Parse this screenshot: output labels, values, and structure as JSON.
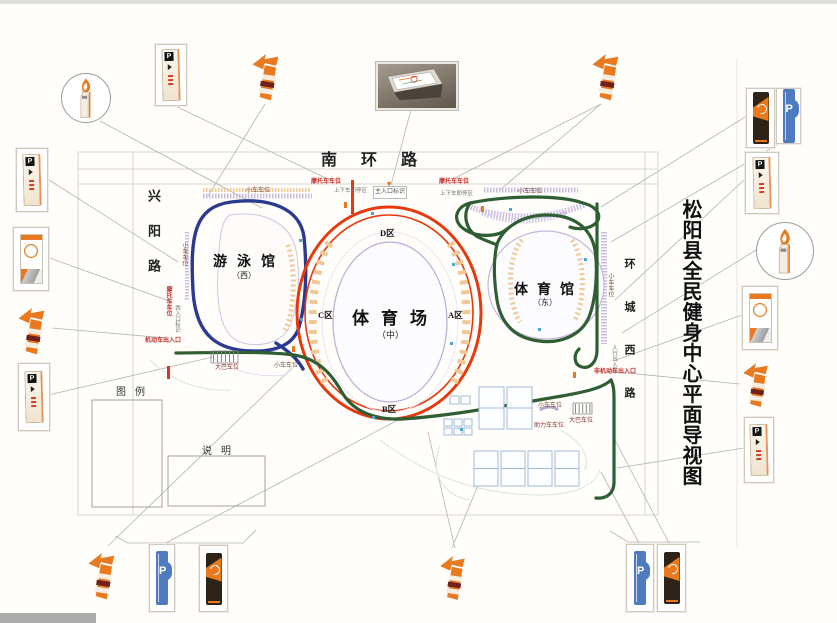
{
  "title": "松阳县全民健身中心平面导视图",
  "roads": {
    "north": "南环路",
    "west": "兴阳路",
    "east": "环城西路"
  },
  "buildings": {
    "pool": {
      "name": "游泳馆",
      "sub": "（西）"
    },
    "stadium": {
      "name": "体育场",
      "sub": "（中）"
    },
    "gym": {
      "name": "体育馆",
      "sub": "（东）"
    }
  },
  "zones": {
    "a": "A区",
    "b": "B区",
    "c": "C区",
    "d": "D区"
  },
  "legend": {
    "title": "图例",
    "note_title": "说明"
  },
  "labels": {
    "car_parking": "小车车位",
    "moto_parking": "摩托车车位",
    "bus_parking": "大巴车位",
    "moped_parking": "助力车车位",
    "dropoff": "上下车即停区",
    "main_entrance_sign": "主入口标识",
    "west_entrance_sign": "西入口标识",
    "vehicle_gate": "机动车出入口",
    "nonmotor_gate": "非机动车出入口",
    "pedestrian_gate": "人行出入口"
  },
  "signs": {
    "p_label": "P"
  },
  "colors": {
    "accent_orange": "#E8791E",
    "road_blue": "#2B3990",
    "road_green": "#2F5D34",
    "stadium_red": "#E8380D",
    "parking_lavender": "#C9BCE0",
    "seating_beige": "#EFC894",
    "blue_p_sign": "#4E7BC0",
    "dark_totem": "#2F2317"
  }
}
